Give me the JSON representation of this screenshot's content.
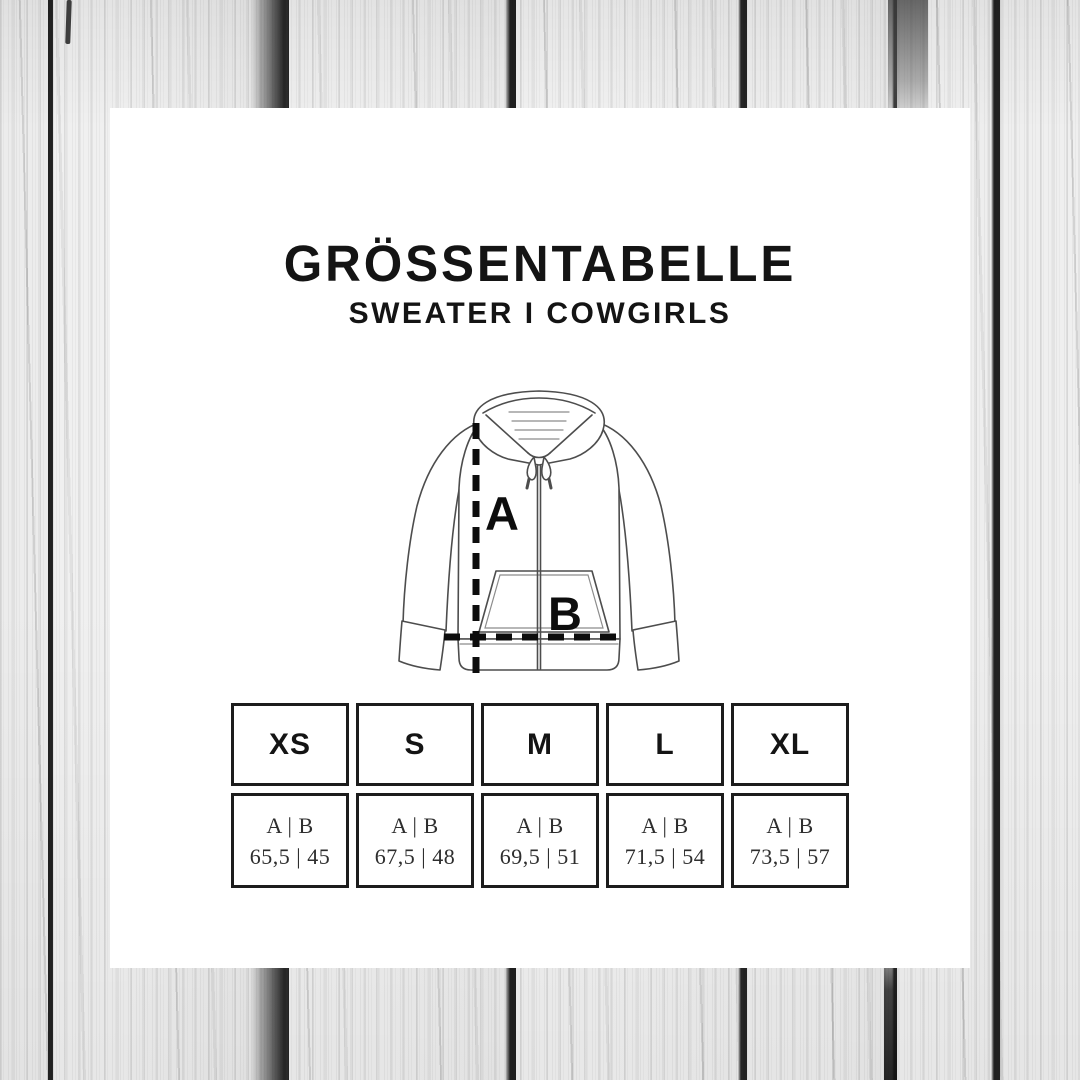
{
  "title": "GRÖSSENTABELLE",
  "subtitle": "SWEATER I COWGIRLS",
  "diagram": {
    "garment": "zip hoodie line drawing",
    "label_a": "A",
    "label_b": "B"
  },
  "table": {
    "measure_label": "A | B",
    "columns": [
      {
        "size": "XS",
        "values": "65,5 | 45"
      },
      {
        "size": "S",
        "values": "67,5 | 48"
      },
      {
        "size": "M",
        "values": "69,5 | 51"
      },
      {
        "size": "L",
        "values": "71,5 | 54"
      },
      {
        "size": "XL",
        "values": "73,5 | 57"
      }
    ]
  },
  "colors": {
    "ink": "#141414",
    "card": "#ffffff",
    "wood_base": "#ececec",
    "seam": "#222222"
  }
}
